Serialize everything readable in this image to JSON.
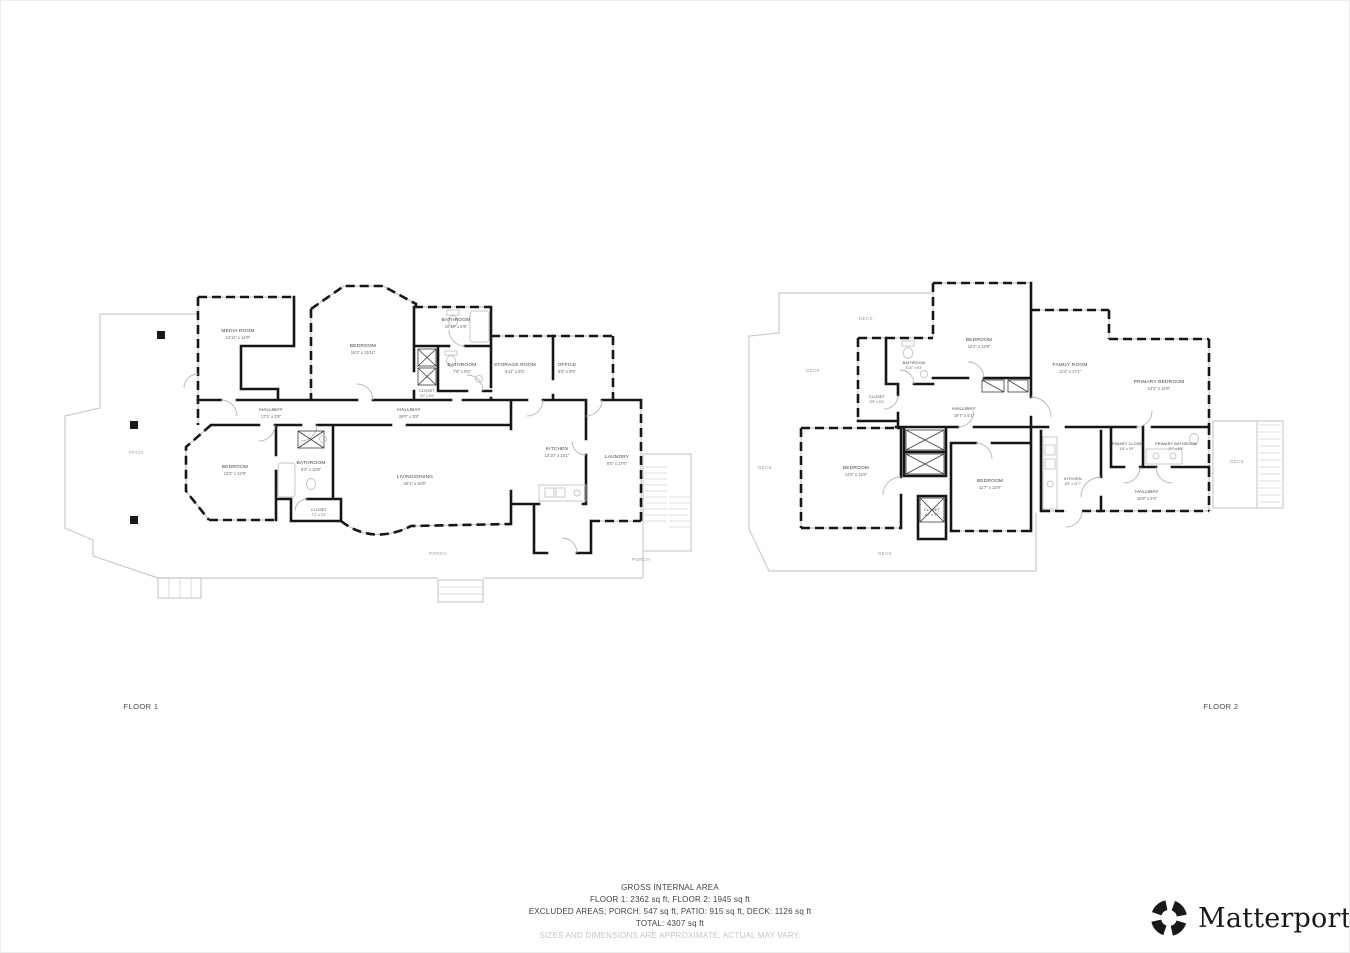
{
  "page": {
    "floor1_label": "FLOOR 1",
    "floor2_label": "FLOOR 2"
  },
  "floor1": {
    "rooms": [
      {
        "name": "MEDIA ROOM",
        "dims": "13'11\" x 14'9\""
      },
      {
        "name": "BEDROOM",
        "dims": "15'2\" x 15'11\""
      },
      {
        "name": "BATHROOM",
        "dims": "10'10\" x 5'8\""
      },
      {
        "name": "BATHROOM",
        "dims": "7'8\" x 6'6\""
      },
      {
        "name": "STORAGE ROOM",
        "dims": "8'11\" x 9'5\""
      },
      {
        "name": "OFFICE",
        "dims": "8'8\" x 9'5\""
      },
      {
        "name": "CLOSET",
        "dims": "3'2\" x 6'6\""
      },
      {
        "name": "HALLWAY",
        "dims": "17'1\" x 3'8\""
      },
      {
        "name": "HALLWAY",
        "dims": "29'0\" x 3'8\""
      },
      {
        "name": "BEDROOM",
        "dims": "13'0\" x 13'9\""
      },
      {
        "name": "BATHROOM",
        "dims": "8'3\" x 10'9\""
      },
      {
        "name": "LIVING/DINING",
        "dims": "26'1\" x 16'9\""
      },
      {
        "name": "CLOSET",
        "dims": "7'2\" x 3'2\""
      },
      {
        "name": "KITCHEN",
        "dims": "10'10\" x 15'1\""
      },
      {
        "name": "LAUNDRY",
        "dims": "8'0\" x 17'6\""
      }
    ],
    "areas": {
      "patio": "PATIO",
      "porch": "PORCH"
    }
  },
  "floor2": {
    "rooms": [
      {
        "name": "BEDROOM",
        "dims": "14'2\" x 13'9\""
      },
      {
        "name": "BATHROOM",
        "dims": "6'10\" x 6'3\""
      },
      {
        "name": "CLOSET",
        "dims": "5'9\" x 5'4\""
      },
      {
        "name": "HALLWAY",
        "dims": "19'7\" x 5'1\""
      },
      {
        "name": "FAMILY ROOM",
        "dims": "11'4\" x 17'1\""
      },
      {
        "name": "PRIMARY BEDROOM",
        "dims": "14'2\" x 12'8\""
      },
      {
        "name": "BEDROOM",
        "dims": "14'6\" x 14'6\""
      },
      {
        "name": "BEDROOM",
        "dims": "11'7\" x 12'9\""
      },
      {
        "name": "KITCHEN",
        "dims": "8'8\" x 11'7\""
      },
      {
        "name": "PRIMARY CLOSET",
        "dims": "4'8\" x 5'9\""
      },
      {
        "name": "PRIMARY BATHROOM",
        "dims": "9'7\" x 5'9\""
      },
      {
        "name": "HALLWAY",
        "dims": "15'8\" x 5'4\""
      },
      {
        "name": "CLOSET",
        "dims": "4'1\" x 4'1\""
      }
    ],
    "deck_label": "DECK"
  },
  "footer": {
    "title": "GROSS INTERNAL AREA",
    "floors": "FLOOR 1: 2362 sq ft, FLOOR 2: 1945 sq ft",
    "excluded": "EXCLUDED AREAS; PORCH: 547 sq ft, PATIO: 915 sq ft, DECK: 1126 sq ft",
    "total": "TOTAL: 4307 sq ft",
    "disclaimer": "SIZES AND DIMENSIONS ARE APPROXIMATE, ACTUAL MAY VARY."
  },
  "brand": {
    "name": "Matterport",
    "mark": "®"
  }
}
